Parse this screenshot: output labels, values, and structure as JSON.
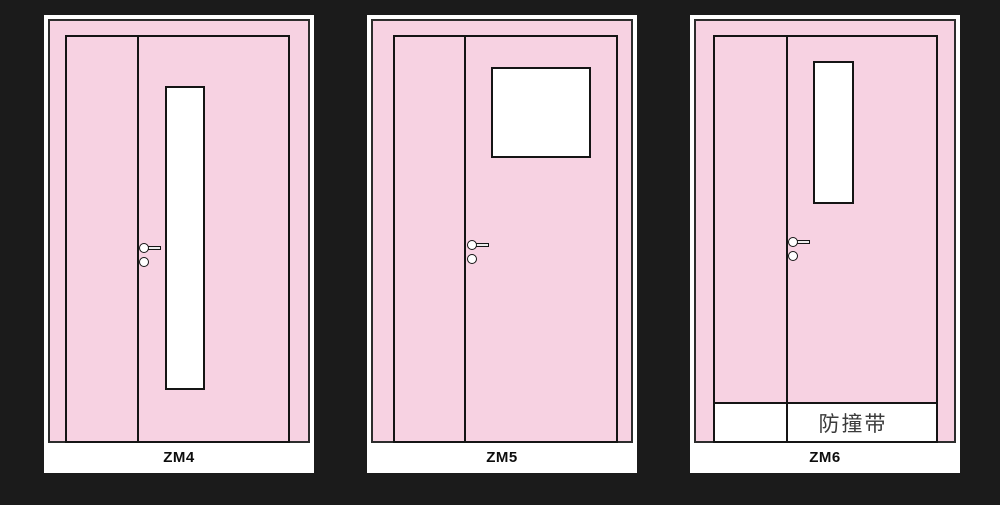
{
  "diagram": {
    "background_color": "#1b1b1b",
    "door_fill_color": "#f7d2e2",
    "line_color": "#151515",
    "panel_color": "#ffffff"
  },
  "doors": [
    {
      "label": "ZM4"
    },
    {
      "label": "ZM5"
    },
    {
      "label": "ZM6",
      "strip_label": "防撞带"
    }
  ]
}
